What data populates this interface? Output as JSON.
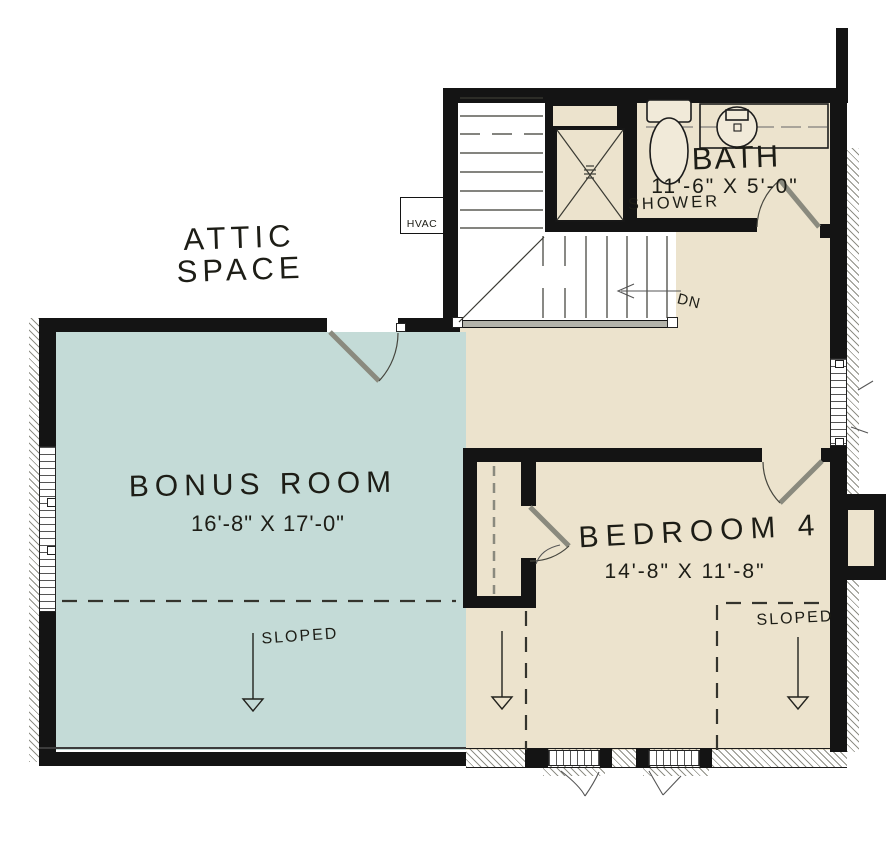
{
  "colors": {
    "bonus_fill": "#c4dbd7",
    "floor_fill": "#ece3cd",
    "wall": "#141414",
    "door": "#8a8a7e",
    "fixture_fill": "#f1ead9"
  },
  "rooms": {
    "attic": {
      "line1": "ATTIC",
      "line2": "SPACE"
    },
    "bonus": {
      "name": "BONUS ROOM",
      "dims": "16'-8\" X 17'-0\""
    },
    "bedroom4": {
      "name": "BEDROOM 4",
      "dims": "14'-8\" X 11'-8\""
    },
    "bath": {
      "name": "BATH",
      "dims": "11'-6\" X 5'-0\""
    }
  },
  "annotations": {
    "shower": "SHOWER",
    "hvac": "HVAC",
    "down": "DN",
    "sloped_bonus": "SLOPED",
    "sloped_bedroom": "SLOPED"
  }
}
